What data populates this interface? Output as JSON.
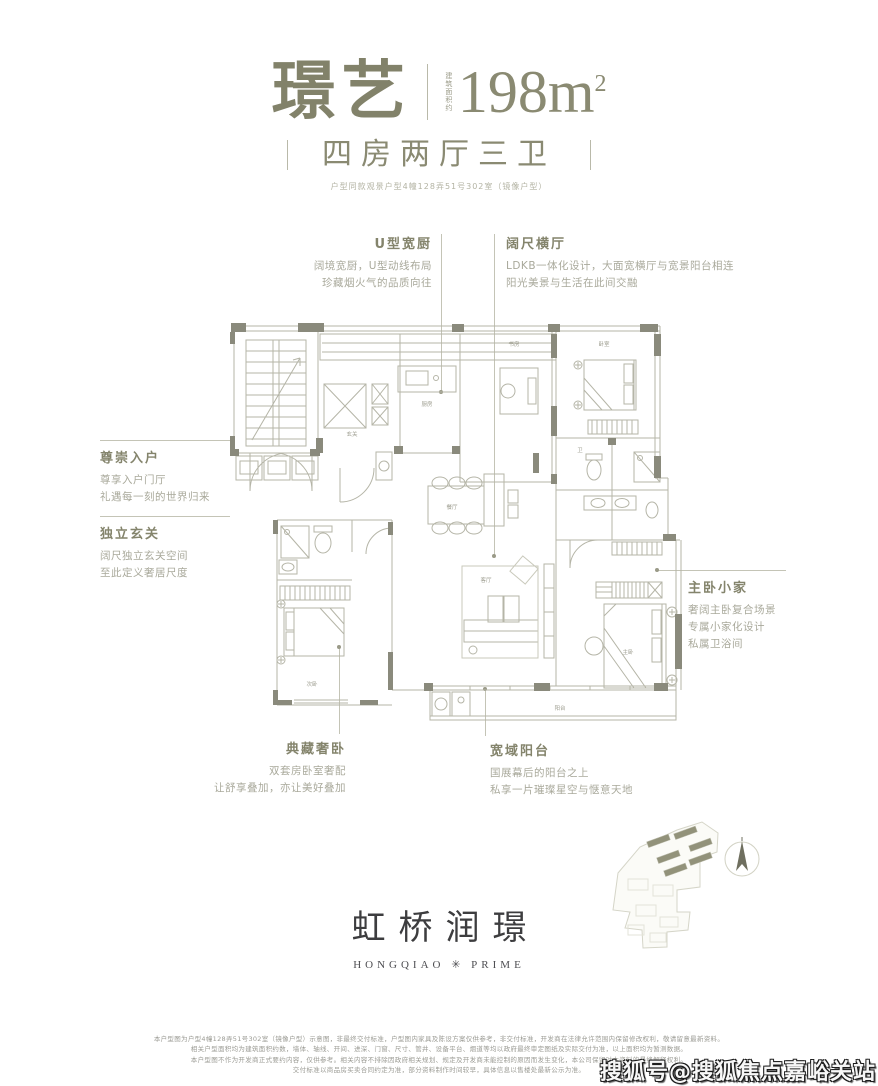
{
  "header": {
    "title": "璟艺",
    "area_prefix": "建筑面积约",
    "area_value": "198m",
    "area_sup": "2",
    "subtitle": "四房两厅三卫",
    "note": "户型同款观景户型4幢128弄51号302室（镜像户型）"
  },
  "annotations": [
    {
      "title": "U型宽厨",
      "lines": [
        "阔境宽厨，U型动线布局",
        "珍藏烟火气的品质向往"
      ]
    },
    {
      "title": "阔尺横厅",
      "lines": [
        "LDKB一体化设计，大面宽横厅与宽景阳台相连",
        "阳光美景与生活在此间交融"
      ]
    },
    {
      "title": "尊崇入户",
      "lines": [
        "尊享入户门厅",
        "礼遇每一刻的世界归来"
      ]
    },
    {
      "title": "独立玄关",
      "lines": [
        "阔尺独立玄关空间",
        "至此定义奢居尺度"
      ]
    },
    {
      "title": "主卧小家",
      "lines": [
        "奢阔主卧复合场景",
        "专属小家化设计",
        "私属卫浴间"
      ]
    },
    {
      "title": "典藏奢卧",
      "lines": [
        "双套房卧室奢配",
        "让舒享叠加，亦让美好叠加"
      ]
    },
    {
      "title": "宽域阳台",
      "lines": [
        "国展幕后的阳台之上",
        "私享一片璀璨星空与惬意天地"
      ]
    }
  ],
  "plan": {
    "room_labels": {
      "kitchen": "厨房",
      "study": "书房",
      "bedroom2": "卧室",
      "dining": "餐厅",
      "living": "客厅",
      "master": "主卧",
      "bedroom3": "次卧",
      "balcony": "阳台",
      "foyer": "玄关",
      "bath": "卫"
    }
  },
  "logo": {
    "cn": "虹桥润璟",
    "en": "HONGQIAO ✳ PRIME"
  },
  "disclaimer": {
    "lines": [
      "本户型图为户型4幢128弄51号302室（镜像户型）示意图，非最终交付标准，户型图内家具及陈设方案仅供参考，非交付标准，开发商在法律允许范围内保留修改权利，敬请留意最新资料。",
      "相关户型面积均为建筑面积约数，墙体、轴线、开间、进深、门窗、尺寸、管井、设备平台、烟道等均以政府最终审定图纸及实际交付为准，以上面积均为暂测数据。",
      "本户型图不作为开发商正式要约内容，仅供参考。相关内容不排除因政府相关规划、规定及开发商未能控制的原因而发生变化，本公司保留对本资料的最终解释权利。",
      "交付标准以商品房买卖合同约定为准，部分资料制作时间较早，具体信息以售楼处最新公示为准。"
    ]
  },
  "watermark": {
    "text": "搜狐号@搜狐焦点嘉峪关站"
  },
  "colors": {
    "accent": "#84846c",
    "body_text": "#a9a99b",
    "plan_line": "#b5b5a7",
    "wall": "#8a8a7c",
    "logo": "#3d3d3f"
  }
}
